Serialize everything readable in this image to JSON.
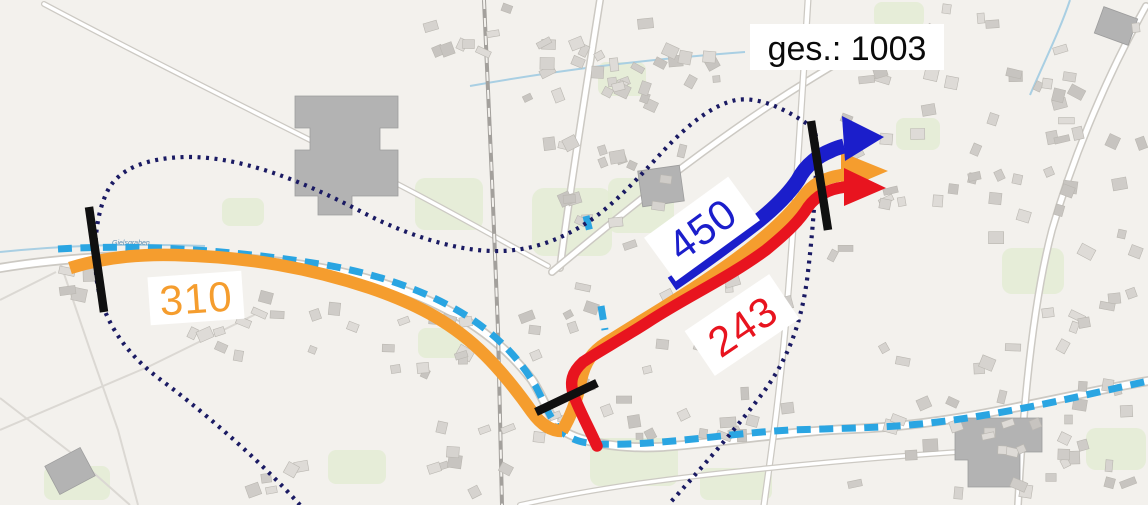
{
  "overlay": {
    "total": {
      "label": "ges.: 1003"
    },
    "flows": [
      {
        "name": "flow-blue",
        "value": "450"
      },
      {
        "name": "flow-orange",
        "value": "310"
      },
      {
        "name": "flow-red",
        "value": "243"
      }
    ]
  },
  "colors": {
    "blue": "#1b1ecb",
    "orange": "#f59d2e",
    "red": "#e8141f",
    "cordon": "#1a1a63",
    "route": "#2aa5e2",
    "screenline": "#101010",
    "label_bg": "#ffffff",
    "total_text": "#0a0a0a"
  },
  "map": {
    "stream_label": "Gielsgraben"
  }
}
